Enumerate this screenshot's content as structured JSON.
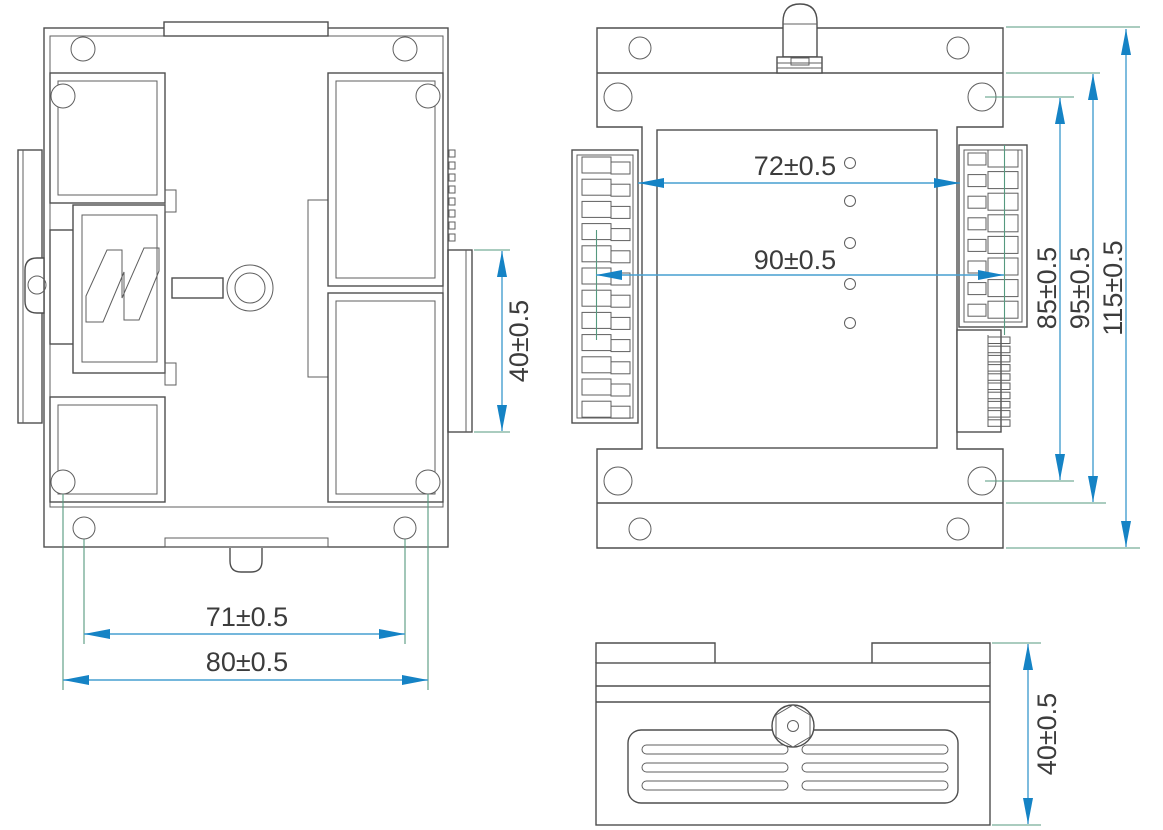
{
  "drawing_type": "mechanical dimensional drawing, three views of DIN-rail module",
  "colors": {
    "background": "#ffffff",
    "outline": "#4e4e4e",
    "dimension_line": "#479fd0",
    "arrow": "#1583c5",
    "extension_line": "#55997f",
    "text": "#3c3c3c"
  },
  "views": {
    "back": {
      "label": "back view with DIN-rail clip",
      "dimensions": {
        "hole_pitch": "71±0.5",
        "overall_width": "80±0.5",
        "rail_flange_depth": "40±0.5"
      }
    },
    "front": {
      "label": "front view with terminal blocks and antenna",
      "dimensions": {
        "terminal_span": "72±0.5",
        "body_width": "90±0.5",
        "mount_hole_pitch": "85±0.5",
        "flange_pitch": "95±0.5",
        "overall_height": "115±0.5"
      }
    },
    "top": {
      "label": "top view with vent grille and antenna nut",
      "dimensions": {
        "overall_depth": "40±0.5"
      }
    }
  }
}
